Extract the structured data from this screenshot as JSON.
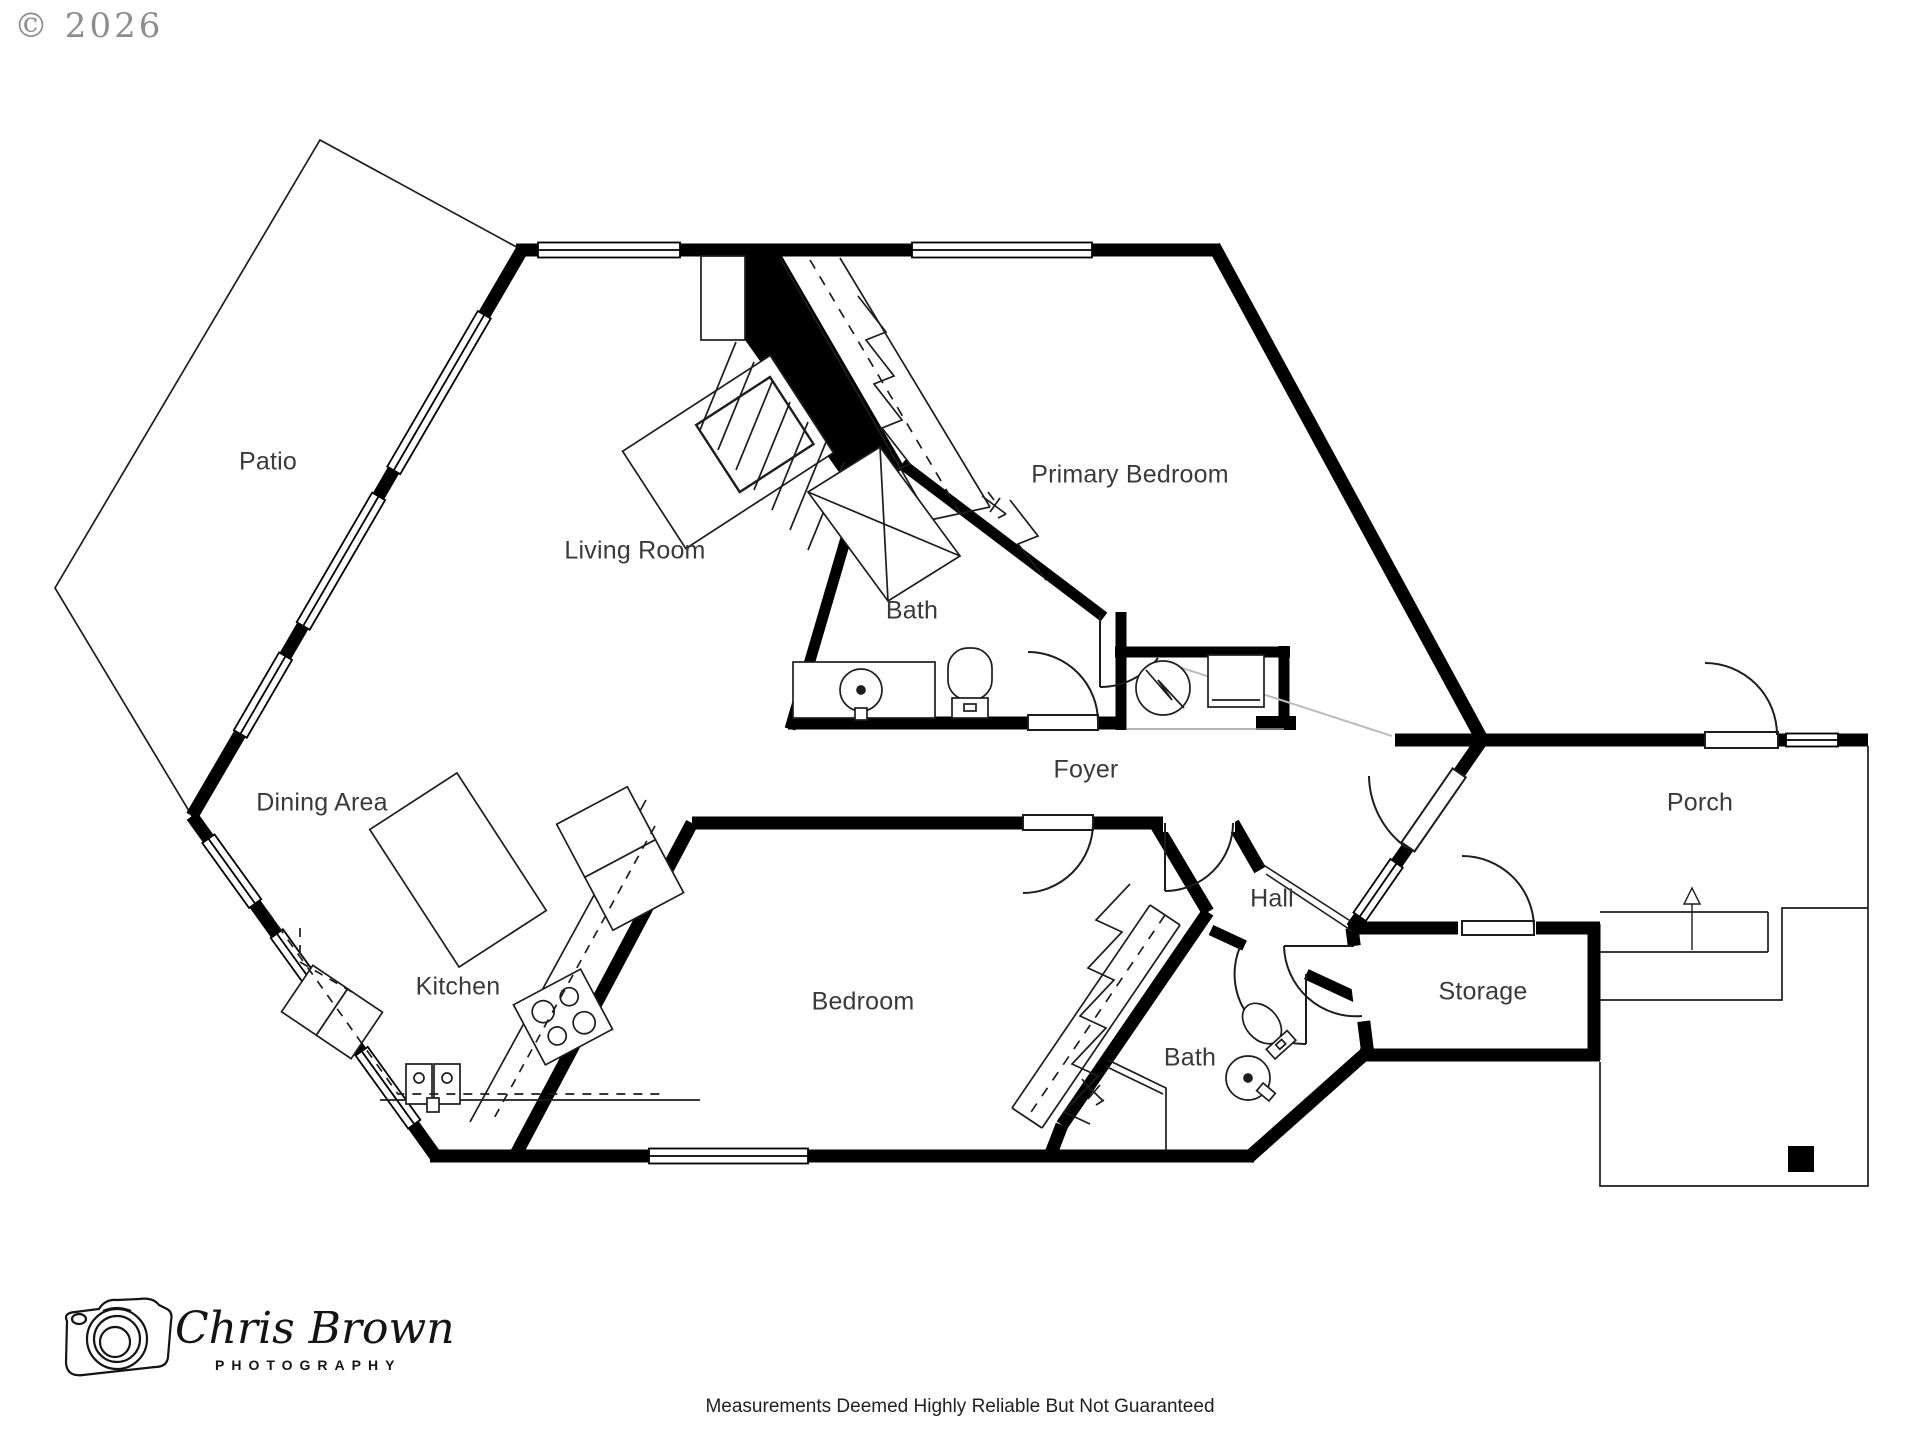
{
  "page": {
    "copyright": "© 2026",
    "disclaimer": "Measurements Deemed Highly Reliable But Not Guaranteed"
  },
  "logo": {
    "name": "Chris Brown",
    "tagline": "PHOTOGRAPHY"
  },
  "rooms": {
    "patio": "Patio",
    "living_room": "Living Room",
    "primary_bedroom": "Primary Bedroom",
    "bath_primary": "Bath",
    "dining_area": "Dining Area",
    "foyer": "Foyer",
    "porch": "Porch",
    "hall": "Hall",
    "kitchen": "Kitchen",
    "bedroom": "Bedroom",
    "storage": "Storage",
    "bath_hall": "Bath"
  },
  "colors": {
    "wall": "#000000",
    "thin_line": "#1d1d1d",
    "label_text": "#3a3a3a",
    "copyright_text": "#8d8d8d",
    "footer_text": "#1f1f1f",
    "background": "#ffffff"
  }
}
